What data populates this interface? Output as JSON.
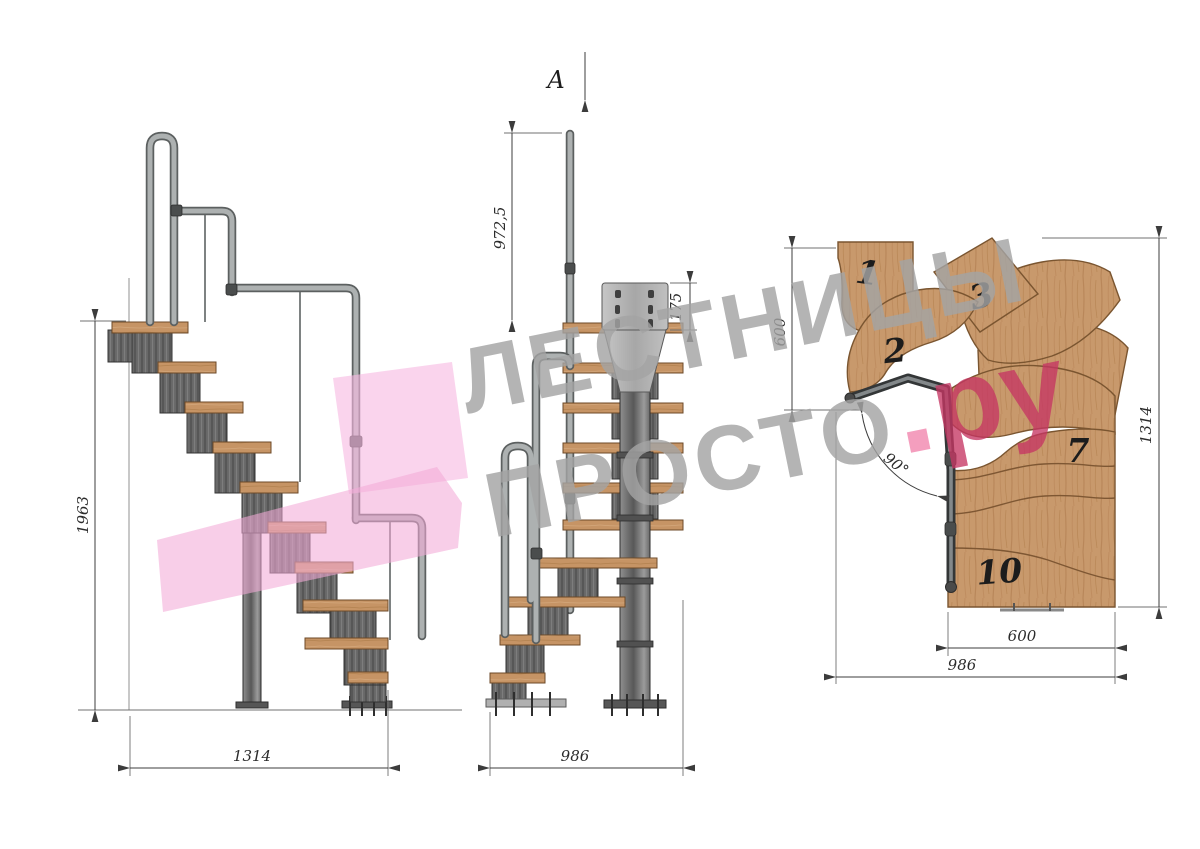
{
  "section_arrow": {
    "label": "A"
  },
  "side_view": {
    "height_dim": "1963",
    "length_dim": "1314"
  },
  "front_view": {
    "post_height_dim": "972,5",
    "plate_height_dim": "175",
    "length_dim": "986"
  },
  "plan_view": {
    "entry_depth_dim": "600",
    "side_length_dim": "1314",
    "flight_width_dim": "600",
    "overall_width_dim": "986",
    "turn_angle_dim": "90°",
    "tread_labels": {
      "t1": "1",
      "t2": "2",
      "t3": "3",
      "t7": "7",
      "t10": "10"
    }
  },
  "watermark": {
    "line1": "ЛЕСТНИЦЫ",
    "line2": "ПРОСТО",
    "dot": ".",
    "suffix": "ру"
  },
  "colors": {
    "wood": "#c8996c",
    "metal": "#5f5f5f",
    "rail": "#adb1b1",
    "watermark_gray": "#a4a4a4",
    "watermark_pink": "#c53663",
    "logo_pink": "#f3aad8"
  }
}
